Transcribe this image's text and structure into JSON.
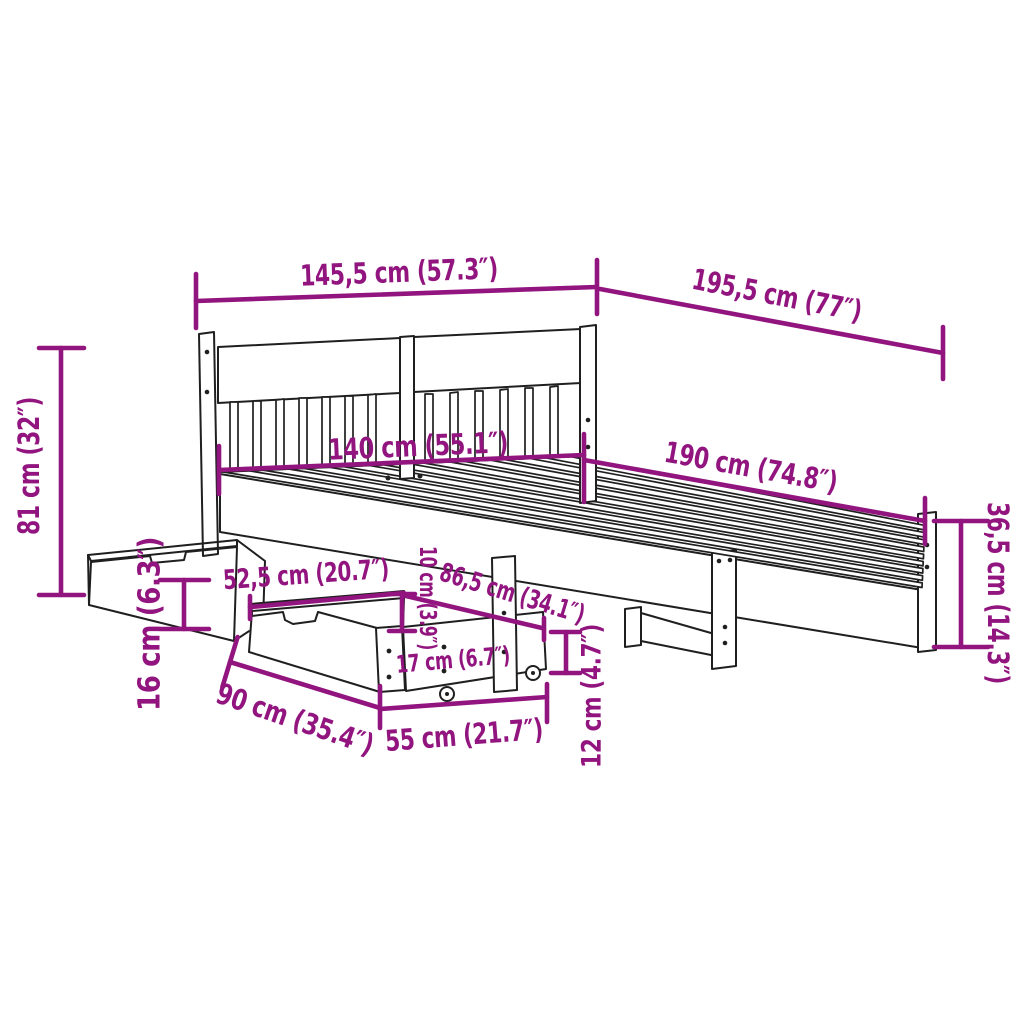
{
  "page": {
    "background": "#ffffff"
  },
  "style": {
    "accent": "#92157F",
    "line_color": "#1f1f1f"
  },
  "diagram": {
    "kind": "product-dimension-diagram",
    "subject": "bed-frame-with-headboard-and-two-storage-drawers",
    "dimensions": [
      {
        "id": "headboard-width",
        "label": "145,5 cm (57.3″)"
      },
      {
        "id": "frame-length",
        "label": "195,5 cm (77″)"
      },
      {
        "id": "headboard-height",
        "label": "81 cm (32″)"
      },
      {
        "id": "mattress-width",
        "label": "140 cm (55.1″)"
      },
      {
        "id": "mattress-length",
        "label": "190 cm (74.8″)"
      },
      {
        "id": "footboard-height",
        "label": "36,5 cm (14.3″)"
      },
      {
        "id": "drawer-top-depth",
        "label": "52,5 cm (20.7″)"
      },
      {
        "id": "drawer-height",
        "label": "16 cm (6.3″)"
      },
      {
        "id": "clearance-height",
        "label": "10 cm (3.9″)"
      },
      {
        "id": "under-bed-width",
        "label": "86,5 cm (34.1″)"
      },
      {
        "id": "drawer-front-height",
        "label": "17 cm (6.7″)"
      },
      {
        "id": "leg-height",
        "label": "12 cm (4.7″)"
      },
      {
        "id": "drawer-length",
        "label": "90 cm (35.4″)"
      },
      {
        "id": "drawer-depth",
        "label": "55 cm (21.7″)"
      }
    ]
  }
}
